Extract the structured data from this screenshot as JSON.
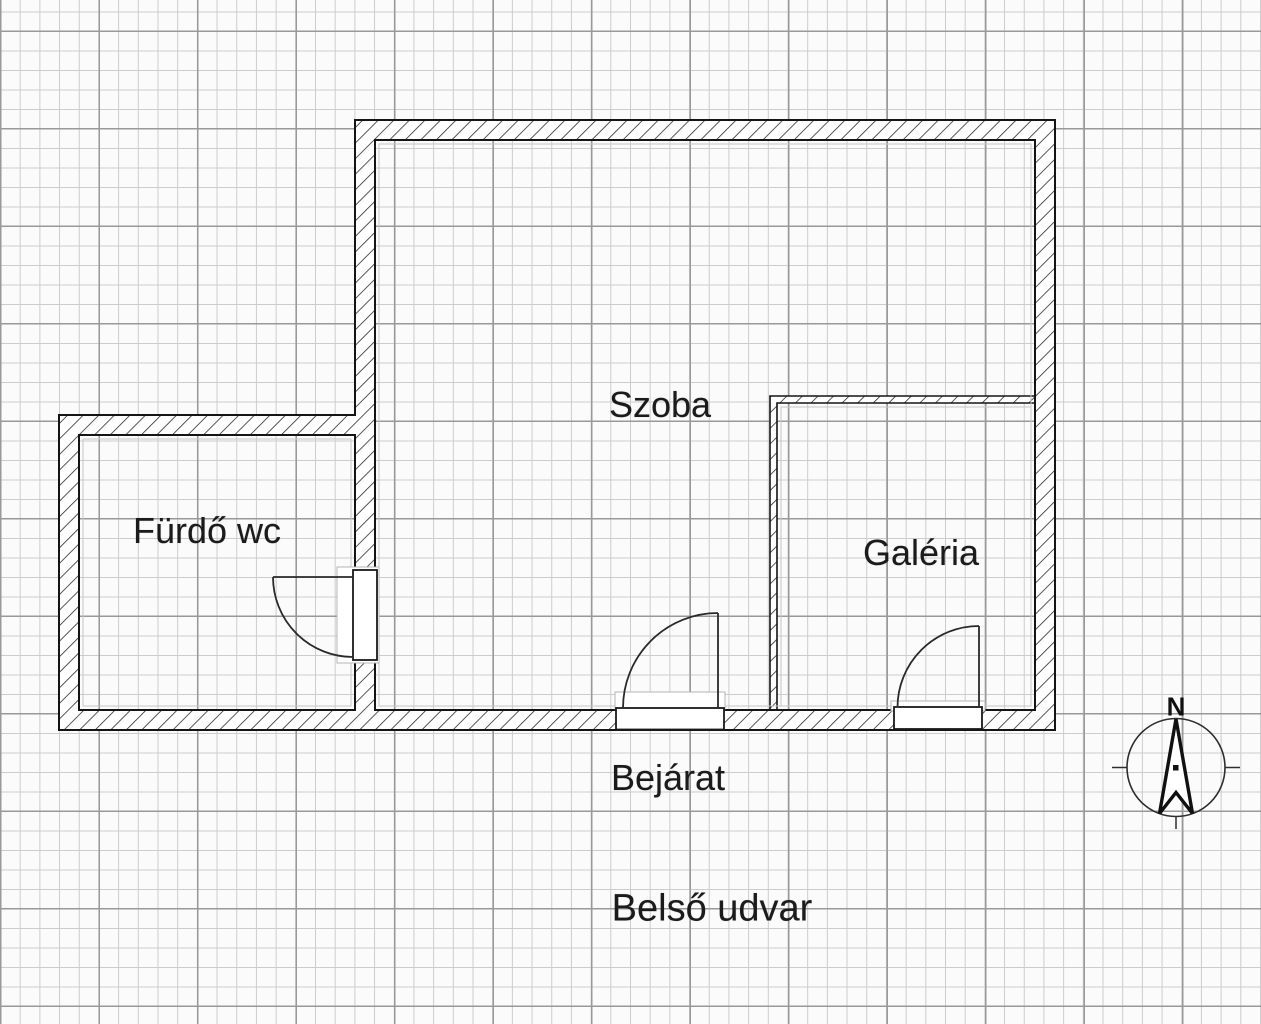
{
  "plan": {
    "rooms": [
      {
        "id": "szoba",
        "label": "Szoba"
      },
      {
        "id": "furdo",
        "label": "Fürdő wc"
      },
      {
        "id": "galeria",
        "label": "Galéria"
      }
    ],
    "annotations": [
      {
        "id": "bejarat",
        "label": "Bejárat"
      },
      {
        "id": "belso-udvar",
        "label": "Belső udvar"
      }
    ],
    "compass": {
      "north_label": "N"
    },
    "colors": {
      "ink": "#1b1b1b",
      "wall_hatch": "#2b2b2b",
      "grid_minor": "#cccccc",
      "grid_major": "#999999",
      "ghost_outline": "#b5b5b5",
      "paper": "#fbfbfb"
    }
  }
}
